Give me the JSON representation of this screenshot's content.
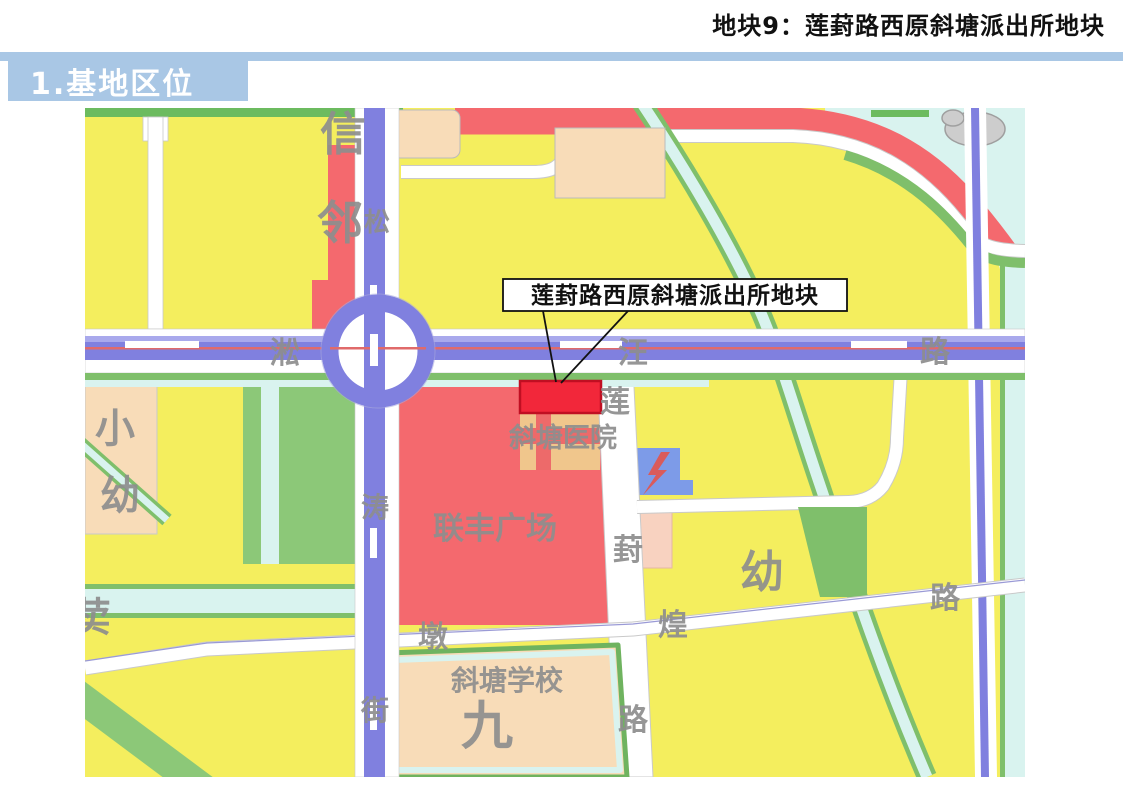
{
  "header": {
    "page_title": "地块9：莲葑路西原斜塘派出所地块"
  },
  "section": {
    "title": "1.基地区位"
  },
  "callout": {
    "label": "莲葑路西原斜塘派出所地块"
  },
  "map_labels": {
    "district": {
      "xin": "信",
      "lin": "邻"
    },
    "songtao_street": {
      "song": "松",
      "tao": "涛",
      "jie": "街"
    },
    "songwang_road": {
      "song": "淞",
      "wang": "汪",
      "lu": "路"
    },
    "lianfeng_road": {
      "lian": "莲",
      "feng": "葑",
      "lu": "路"
    },
    "dunhuang_road": {
      "dun": "墩",
      "huang": "煌",
      "lu": "路"
    },
    "places": {
      "hospital": "斜塘医院",
      "plaza": "联丰广场",
      "school": "斜塘学校",
      "jiu": "九",
      "xiao": "小",
      "you_left": "幼",
      "you_right": "幼",
      "mai": "荬"
    }
  },
  "colors": {
    "header_blue": "#A9C7E5",
    "parcel_yellow": "#F4EE5E",
    "residential_red": "#F4696E",
    "highlight_parcel_red": "#F2273A",
    "water_cyan": "#D9F3EF",
    "greenery": "#8CC878",
    "road_purple": "#8080DF",
    "peach_block": "#F8DCB8",
    "label_gray": "#8E8E8E"
  }
}
